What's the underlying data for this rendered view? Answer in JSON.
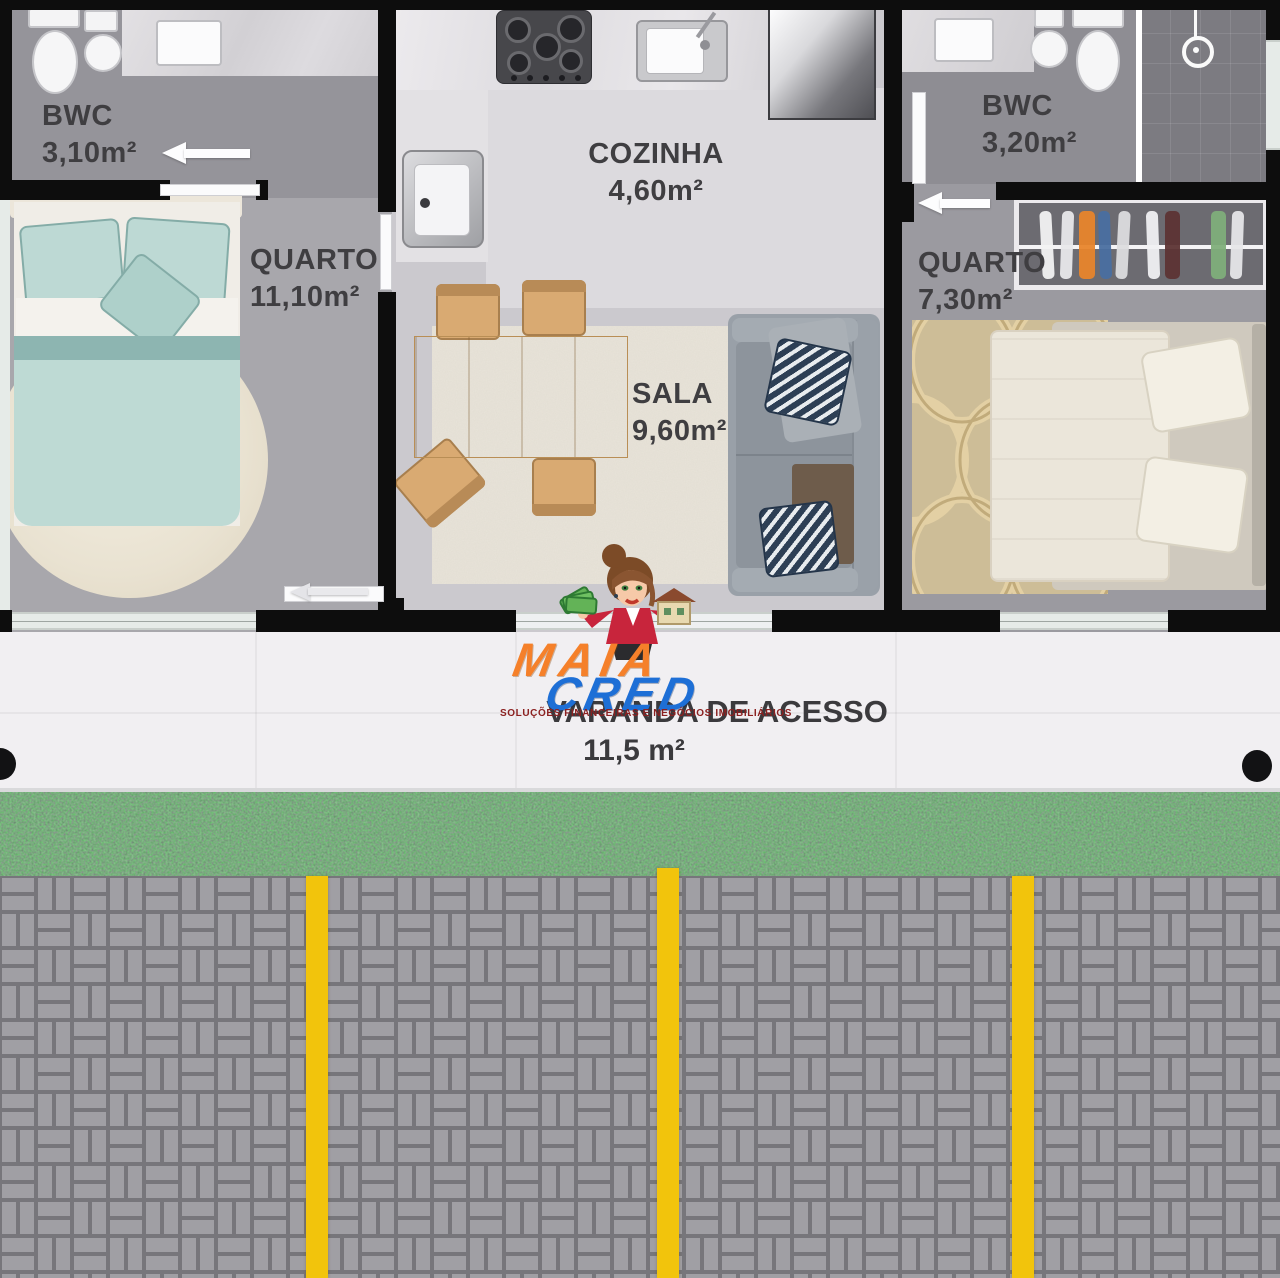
{
  "plan": {
    "rooms": {
      "bwc_left": {
        "name": "BWC",
        "area": "3,10m²"
      },
      "quarto_left": {
        "name": "QUARTO",
        "area": "11,10m²"
      },
      "cozinha": {
        "name": "COZINHA",
        "area": "4,60m²"
      },
      "sala": {
        "name": "SALA",
        "area": "9,60m²"
      },
      "bwc_right": {
        "name": "BWC",
        "area": "3,20m²"
      },
      "quarto_right": {
        "name": "QUARTO",
        "area": "7,30m²"
      },
      "varanda": {
        "name": "VARANDA DE ACESSO",
        "area": "11,5 m²"
      }
    }
  },
  "watermark": {
    "brand_top": "MAIA",
    "brand_bottom": "CRED",
    "tagline": "SOLUÇÕES FINANCEIRAS E NEGÓCIOS IMOBILIÁRIOS"
  },
  "palette": {
    "wall": "#0d0d0d",
    "brand_orange": "#f5802a",
    "brand_blue": "#1e6fd6",
    "tagline_red": "#8b2020",
    "grass_green": "#47734c",
    "paver_gray": "#a09fa4",
    "line_yellow": "#f2c40c"
  }
}
